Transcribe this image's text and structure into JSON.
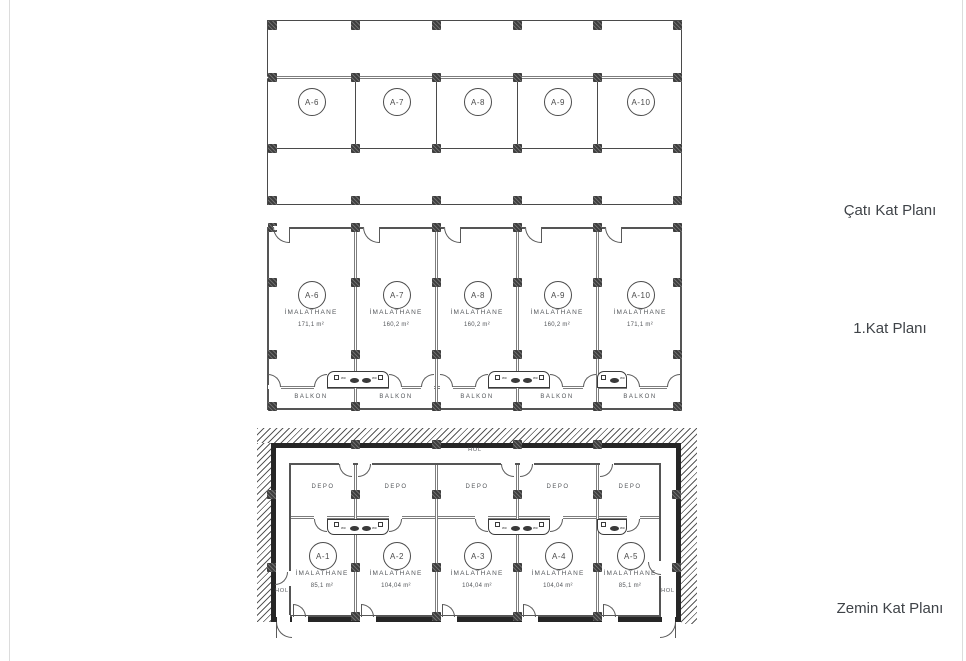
{
  "titles": {
    "roof": "Çatı Kat Planı",
    "first": "1.Kat Planı",
    "ground": "Zemin Kat Planı"
  },
  "roof_plan": {
    "units": [
      {
        "id": "A-6"
      },
      {
        "id": "A-7"
      },
      {
        "id": "A-8"
      },
      {
        "id": "A-9"
      },
      {
        "id": "A-10"
      }
    ]
  },
  "first_plan": {
    "balcony_label": "BALKON",
    "wc_label": "wc",
    "units": [
      {
        "id": "A-6",
        "room": "İMALATHANE",
        "area": "171,1 m²"
      },
      {
        "id": "A-7",
        "room": "İMALATHANE",
        "area": "160,2 m²"
      },
      {
        "id": "A-8",
        "room": "İMALATHANE",
        "area": "160,2 m²"
      },
      {
        "id": "A-9",
        "room": "İMALATHANE",
        "area": "160,2 m²"
      },
      {
        "id": "A-10",
        "room": "İMALATHANE",
        "area": "171,1 m²"
      }
    ]
  },
  "ground_plan": {
    "hall_label": "HOL",
    "storage_label": "DEPO",
    "wc_label": "wc",
    "units": [
      {
        "id": "A-1",
        "room": "İMALATHANE",
        "area": "85,1 m²"
      },
      {
        "id": "A-2",
        "room": "İMALATHANE",
        "area": "104,04 m²"
      },
      {
        "id": "A-3",
        "room": "İMALATHANE",
        "area": "104,04 m²"
      },
      {
        "id": "A-4",
        "room": "İMALATHANE",
        "area": "104,04 m²"
      },
      {
        "id": "A-5",
        "room": "İMALATHANE",
        "area": "85,1 m²"
      }
    ]
  }
}
